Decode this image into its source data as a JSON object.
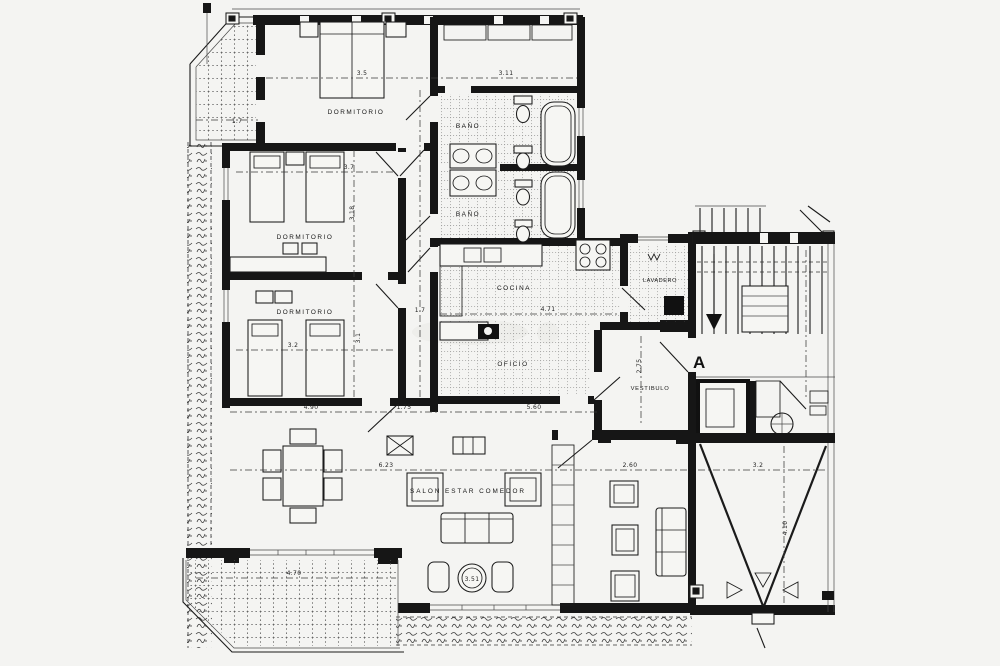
{
  "rooms": {
    "dorm1": "DORMITORIO",
    "dorm2": "DORMITORIO",
    "dorm3": "DORMITORIO",
    "bano1": "BAÑO",
    "bano2": "BAÑO",
    "cocina": "COCINA",
    "oficio": "OFICIO",
    "lavadero": "LAVADERO",
    "vestibulo": "VESTIBULO",
    "salon": "SALON ESTAR COMEDOR"
  },
  "stair": {
    "section_label": "A"
  },
  "dims": {
    "dorm1_width": "3.5",
    "bath_block_width": "3.11",
    "dorm2_width": "3.7",
    "dorm2_depth": "3.18",
    "dorm3_width": "3.2",
    "dorm3_depth": "3.1",
    "hall_width": "1.7",
    "terrace_top": "1.7",
    "cocina_width": "4.71",
    "salon_left": "4.90",
    "salon_mid": "1.75",
    "salon_right": "5.60",
    "salon_width": "6.23",
    "sitting_width": "2.60",
    "vterrace_width": "3.2",
    "vterrace_depth": "4.10",
    "vestibulo_depth": "2.75",
    "terrace_bottom": "4.70",
    "salon_circle": "3.51"
  }
}
